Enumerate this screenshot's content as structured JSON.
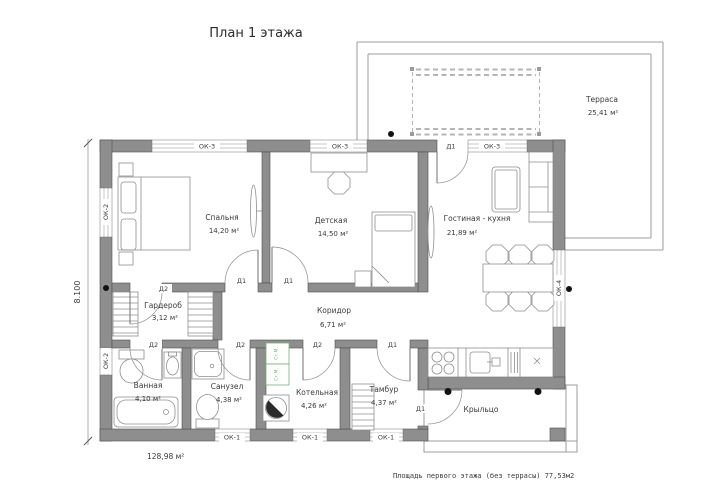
{
  "title": "План 1 этажа",
  "footer_note": "Площадь первого этажа (без террасы)  77,53м2",
  "total_area": "128,98 м²",
  "dimensions": {
    "left_height": "8.100"
  },
  "rooms": {
    "bedroom": {
      "name": "Спальня",
      "area": "14,20 м²"
    },
    "kids": {
      "name": "Детская",
      "area": "14,50 м²"
    },
    "living": {
      "name": "Гостиная - кухня",
      "area": "21,89 м²"
    },
    "terrace": {
      "name": "Терраса",
      "area": "25,41 м²"
    },
    "wardrobe": {
      "name": "Гардероб",
      "area": "3,12 м²"
    },
    "corridor": {
      "name": "Коридор",
      "area": "6,71 м²"
    },
    "bathroom": {
      "name": "Ванная",
      "area": "4,10 м²"
    },
    "wc": {
      "name": "Санузел",
      "area": "4,38 м²"
    },
    "boiler": {
      "name": "Котельная",
      "area": "4,26 м²"
    },
    "tambour": {
      "name": "Тамбур",
      "area": "4,37 м²"
    },
    "porch": {
      "name": "Крыльцо",
      "area": ""
    }
  },
  "openings": {
    "ok1": "ОК-1",
    "ok2": "ОК-2",
    "ok3": "ОК-3",
    "ok4": "ОК-4",
    "d1": "Д1",
    "d2": "Д2"
  },
  "equipment": {
    "washer": "Ст.М."
  },
  "colors": {
    "wall": "#8e8e8e",
    "drawing_line": "#8f8f8f",
    "washer_green": "#7fae7f",
    "column_dot": "#121212"
  }
}
